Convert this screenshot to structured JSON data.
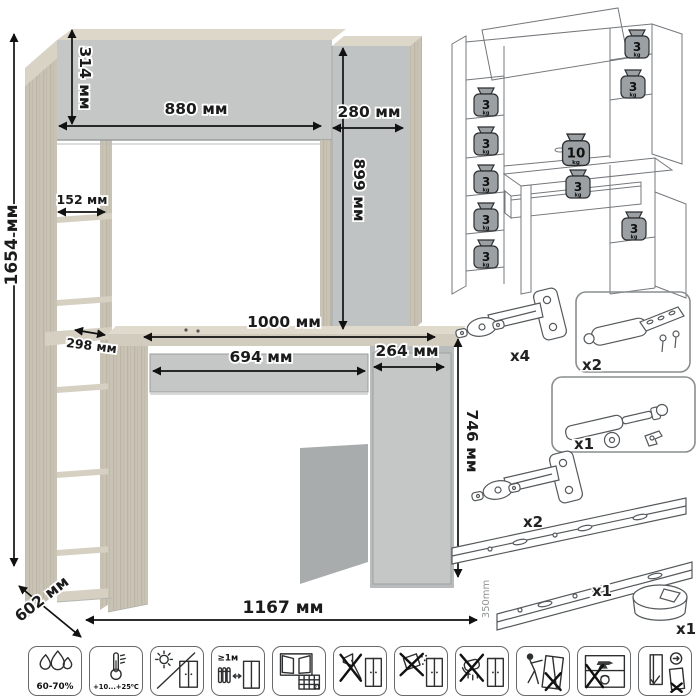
{
  "main_diagram": {
    "dimensions": [
      {
        "id": "total-height",
        "label": "1654 мм"
      },
      {
        "id": "top-cabinet-height",
        "label": "314 мм"
      },
      {
        "id": "top-cabinet-width",
        "label": "880 мм"
      },
      {
        "id": "side-cabinet-width",
        "label": "280 мм"
      },
      {
        "id": "side-cabinet-height",
        "label": "899 мм"
      },
      {
        "id": "shelf-depth",
        "label": "152 мм"
      },
      {
        "id": "lower-shelf-depth",
        "label": "298 мм"
      },
      {
        "id": "desktop-width",
        "label": "1000 мм"
      },
      {
        "id": "drawer-width",
        "label": "694 мм"
      },
      {
        "id": "pedestal-width",
        "label": "264 мм"
      },
      {
        "id": "desk-height",
        "label": "746 мм"
      },
      {
        "id": "depth",
        "label": "602 мм"
      },
      {
        "id": "total-width",
        "label": "1167 мм"
      }
    ]
  },
  "load_diagram": {
    "weights": [
      {
        "value": "3",
        "unit": "kg"
      },
      {
        "value": "3",
        "unit": "kg"
      },
      {
        "value": "3",
        "unit": "kg"
      },
      {
        "value": "3",
        "unit": "kg"
      },
      {
        "value": "3",
        "unit": "kg"
      },
      {
        "value": "3",
        "unit": "kg"
      },
      {
        "value": "3",
        "unit": "kg"
      },
      {
        "value": "10",
        "unit": "kg"
      },
      {
        "value": "3",
        "unit": "kg"
      },
      {
        "value": "3",
        "unit": "kg"
      }
    ]
  },
  "hardware": {
    "items": [
      {
        "name": "concealed-hinge",
        "qty": "x4"
      },
      {
        "name": "door-damper",
        "qty": "x2"
      },
      {
        "name": "gas-lift",
        "qty": "x1"
      },
      {
        "name": "concealed-hinge-small",
        "qty": "x2"
      },
      {
        "name": "drawer-slides",
        "qty": "x1",
        "length": "350mm"
      },
      {
        "name": "cable-grommet",
        "qty": "x1"
      }
    ]
  },
  "care_icons": [
    {
      "name": "humidity",
      "label": "60-70%"
    },
    {
      "name": "temperature",
      "label": "+10...+25⁰C"
    },
    {
      "name": "no-direct-sunlight",
      "label": ""
    },
    {
      "name": "radiator-distance",
      "label": "≥1м"
    },
    {
      "name": "ventilation",
      "label": "21"
    },
    {
      "name": "no-sharp-tools",
      "label": ""
    },
    {
      "name": "no-abrasives",
      "label": ""
    },
    {
      "name": "no-wet-cleaning",
      "label": ""
    },
    {
      "name": "no-dragging",
      "label": ""
    },
    {
      "name": "no-overloading",
      "label": ""
    },
    {
      "name": "door-adjustment",
      "label": ""
    }
  ]
}
